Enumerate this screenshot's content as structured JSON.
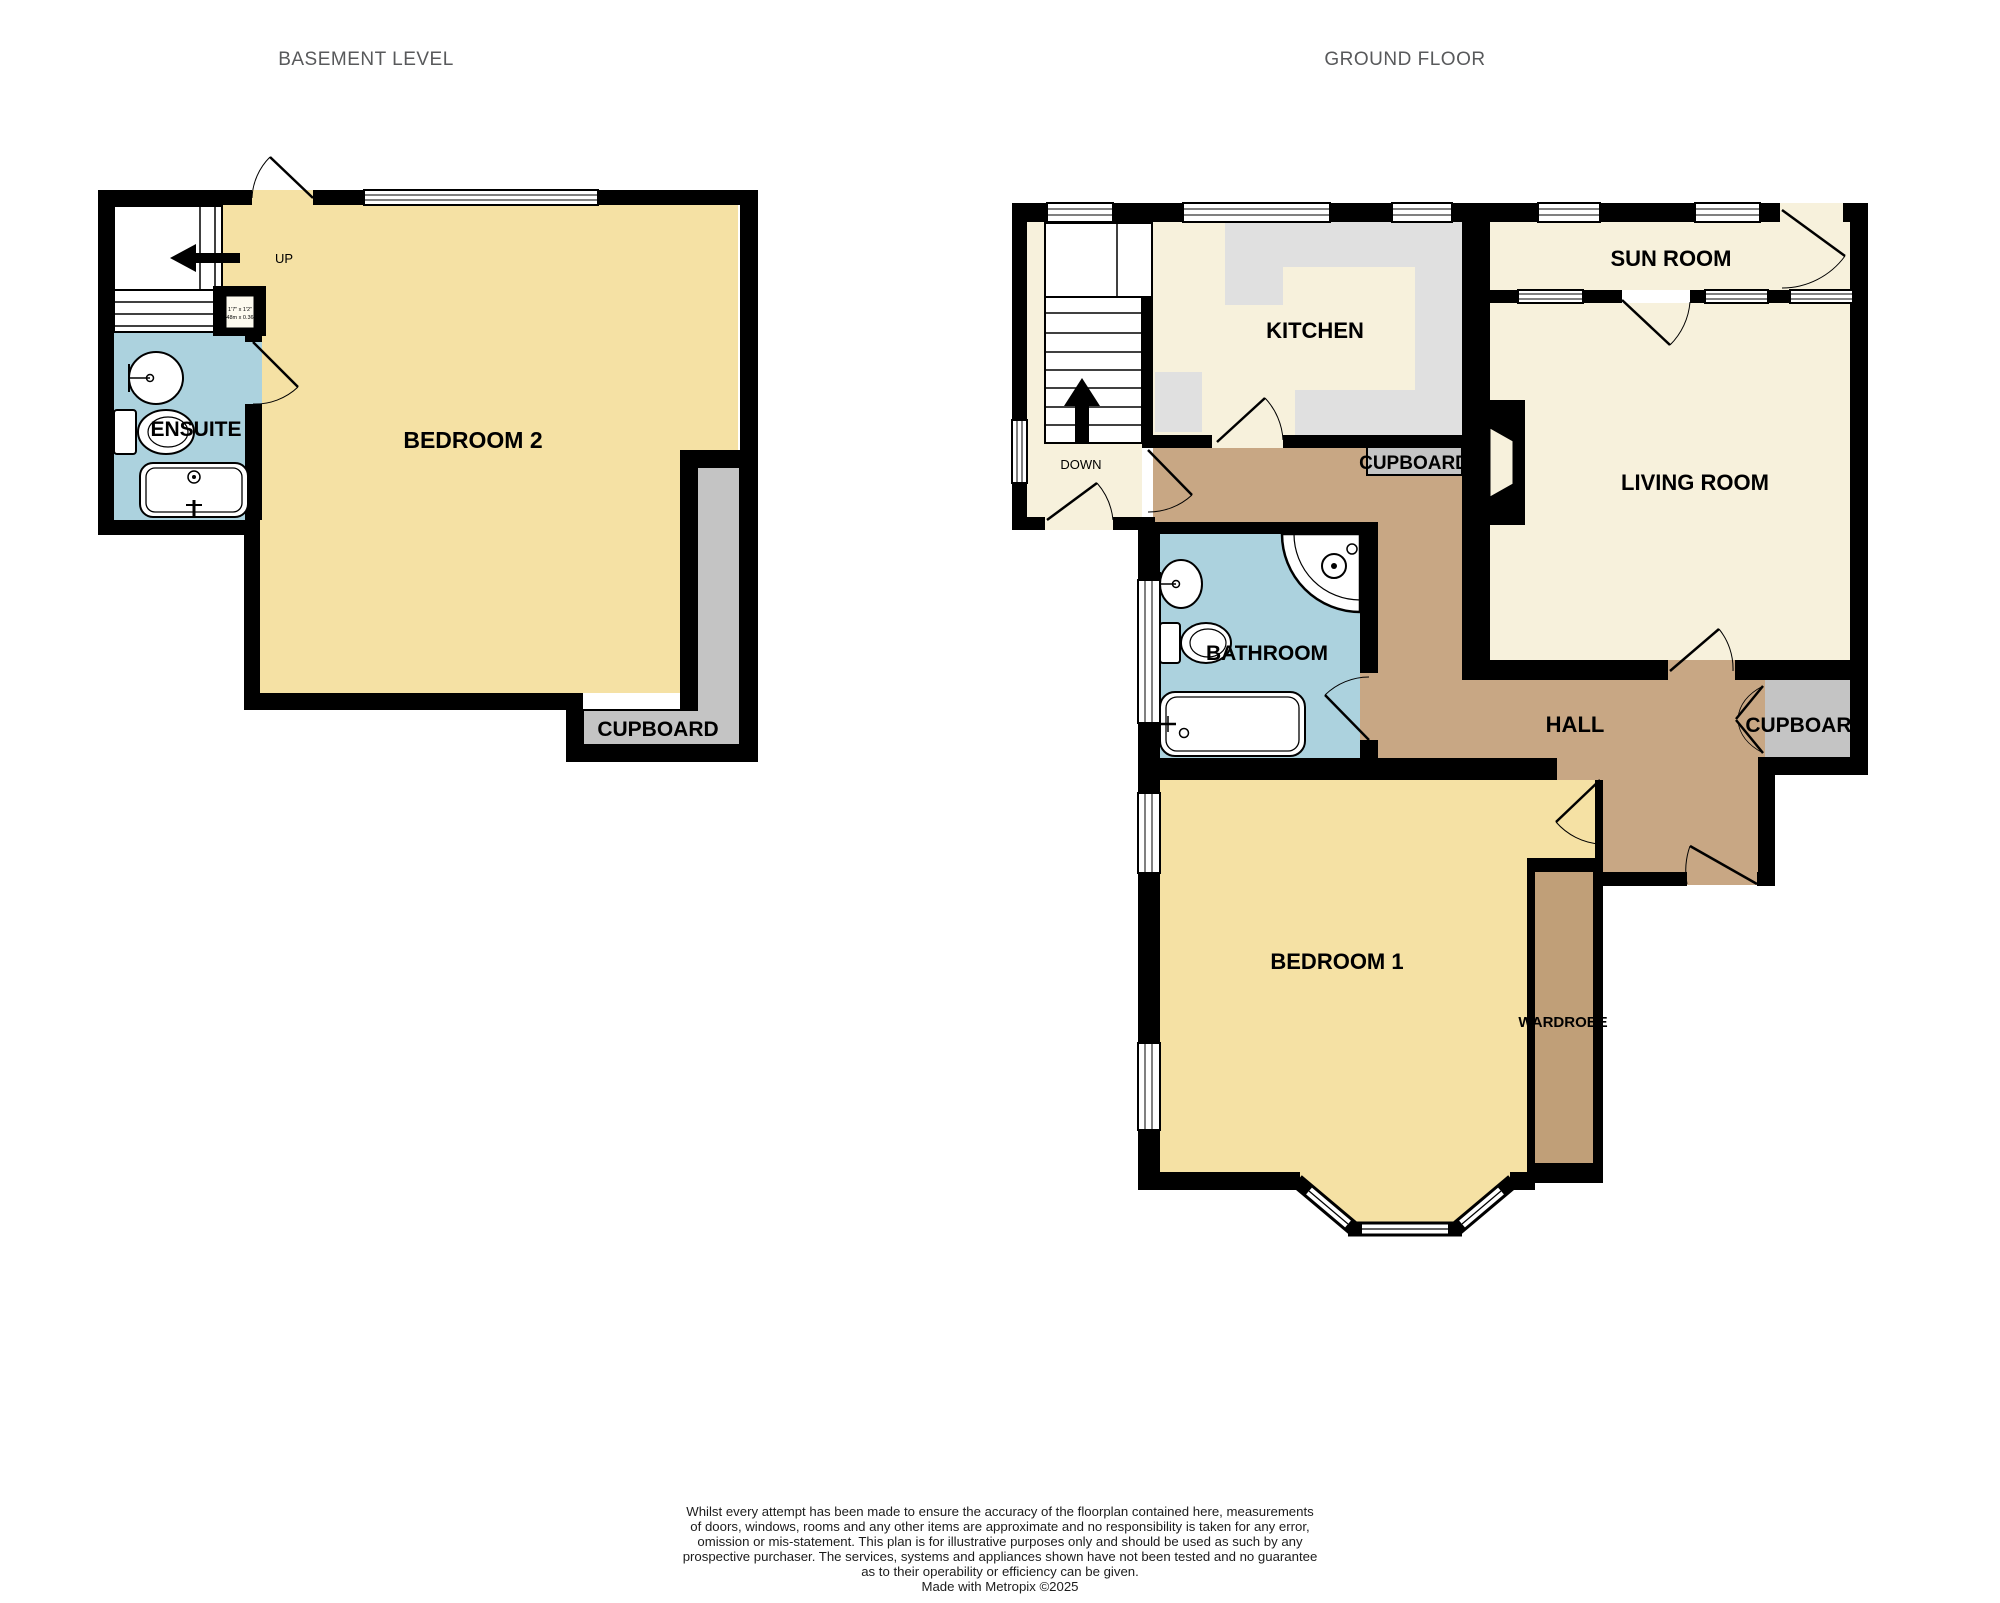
{
  "titles": {
    "basement": "BASEMENT LEVEL",
    "ground": "GROUND FLOOR"
  },
  "basement": {
    "labels": {
      "up": "UP",
      "ensuite": "ENSUITE",
      "bedroom2": "BEDROOM 2",
      "cupboard": "CUPBOARD",
      "store_dim_imperial": "1'7\" x 1'2\"",
      "store_dim_metric": "0.48m x 0.36m"
    }
  },
  "ground": {
    "labels": {
      "down": "DOWN",
      "kitchen": "KITCHEN",
      "sunroom": "SUN ROOM",
      "living": "LIVING ROOM",
      "cupboard_top": "CUPBOARD",
      "bathroom": "BATHROOM",
      "hall": "HALL",
      "cupboard_right": "CUPBOARD",
      "bedroom1": "BEDROOM 1",
      "wardrobe": "WARDROBE"
    }
  },
  "footer": {
    "lines": [
      "Whilst every attempt has been made to ensure the accuracy of the floorplan contained here, measurements",
      "of doors, windows, rooms and any other items are approximate and no responsibility is taken for any error,",
      "omission or mis-statement. This plan is for illustrative purposes only and should be used as such by any",
      "prospective purchaser. The services, systems and appliances shown have not been tested and no guarantee",
      "as to their operability or efficiency can be given.",
      "Made with Metropix ©2025"
    ]
  },
  "colors": {
    "wall": "#000000",
    "room_yellow": "#F5E1A4",
    "room_cream": "#F7F1DC",
    "room_blue": "#ACD2DE",
    "hall_tan": "#C8A784",
    "wardrobe_tan": "#C09F78",
    "cupboard_gray": "#C4C4C4",
    "counter_gray": "#E0E0E0",
    "title_gray": "#58595B"
  }
}
